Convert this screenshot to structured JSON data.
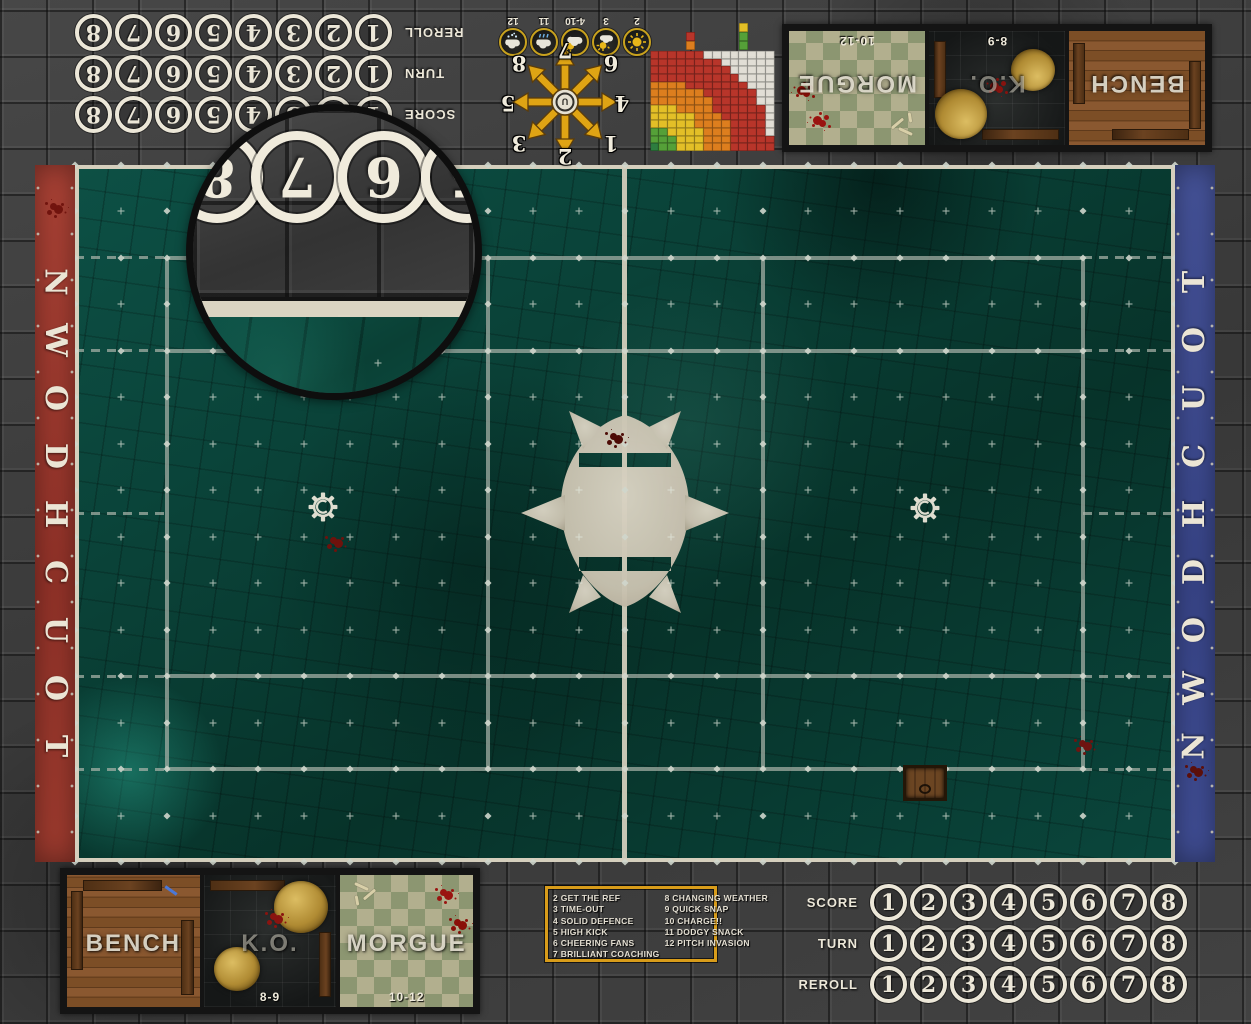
{
  "colors": {
    "endzone_red": "#a33d30",
    "endzone_blue": "#425099",
    "gold": "#d89c1a",
    "pitch_teal": "#0a4238",
    "line_grey": "#a8b2a8",
    "bone_white": "#ece7d8"
  },
  "endzones": {
    "touchdown_left": {
      "text": "TOUCHDOWN"
    },
    "touchdown_right": {
      "text": "TOUCHDOWN"
    }
  },
  "trackers": {
    "numbers": [
      "1",
      "2",
      "3",
      "4",
      "5",
      "6",
      "7",
      "8"
    ],
    "rows": [
      {
        "label": "SCORE"
      },
      {
        "label": "TURN"
      },
      {
        "label": "REROLL"
      }
    ]
  },
  "magnifier": {
    "numbers": [
      "8",
      "7",
      "6",
      "5"
    ]
  },
  "weather": {
    "entries": [
      {
        "value": "2",
        "icon": "sun-icon"
      },
      {
        "value": "3",
        "icon": "sun-cloud-icon"
      },
      {
        "value": "4-10",
        "icon": "cloud-sun-icon"
      },
      {
        "value": "11",
        "icon": "rain-cloud-icon"
      },
      {
        "value": "12",
        "icon": "snow-cloud-icon"
      }
    ]
  },
  "scatter": {
    "center_icon": "gear-logo-icon",
    "numbers": [
      {
        "value": "1",
        "pos": "tl"
      },
      {
        "value": "2",
        "pos": "t"
      },
      {
        "value": "3",
        "pos": "tr"
      },
      {
        "value": "4",
        "pos": "l"
      },
      {
        "value": "5",
        "pos": "r"
      },
      {
        "value": "6",
        "pos": "bl"
      },
      {
        "value": "7",
        "pos": "b"
      },
      {
        "value": "8",
        "pos": "br"
      }
    ]
  },
  "chart_data": {
    "type": "heatmap",
    "title": "passing range ruler (shown rotated 180°, thrower corner top-right)",
    "palette": {
      "R": "#b8352a",
      "O": "#dd7e1e",
      "Y": "#e3bf27",
      "G": "#55a038",
      "D": "#2d7d3f",
      "W": "#efece2"
    },
    "bands": {
      "G": "quick pass",
      "Y": "short pass",
      "O": "long pass",
      "R": "long bomb",
      "W": "out of range",
      "D": "thrower corner"
    },
    "legend_left": [
      "R",
      "O"
    ],
    "legend_right": [
      "Y",
      "G",
      "G"
    ],
    "rows": [
      "RRRRROOOYYYGGD",
      "RRRRROOOYYYGGG",
      "WRRRROOOYYYYGG",
      "WRRRROOOOYYYYY",
      "WRRRRROOOYYYYY",
      "WRRRRRROOOOYYY",
      "WWRRRRROOOOOOO",
      "WWRRRRRROOOOOO",
      "WWWRRRRRRROOOO",
      "WWWWRRRRRRRRRR",
      "WWWWWRRRRRRRRR",
      "WWWWWWRRRRRRRR",
      "WWWWWWWWRRRRRR"
    ]
  },
  "dugouts": {
    "zones": [
      {
        "label": "BENCH"
      },
      {
        "label": "K.O.",
        "range": "8-9"
      },
      {
        "label": "MORGUE",
        "range": "10-12"
      }
    ]
  },
  "kickoff": {
    "left": [
      "2 GET THE REF",
      "3 TIME-OUT",
      "4 SOLID DEFENCE",
      "5 HIGH KICK",
      "6 CHEERING FANS",
      "7 BRILLIANT COACHING"
    ],
    "right": [
      "8 CHANGING WEATHER",
      "9 QUICK SNAP",
      "10 CHARGE!!",
      "11 DODGY SNACK",
      "12 PITCH INVASION"
    ]
  },
  "pitch": {
    "cols": 24,
    "rows": 15,
    "center_col": 12,
    "major_cols": [
      2,
      9,
      15,
      22
    ],
    "major_rows": [
      2,
      4,
      11,
      13
    ],
    "dash_rows": [
      2,
      4,
      7.5,
      11,
      13
    ]
  }
}
